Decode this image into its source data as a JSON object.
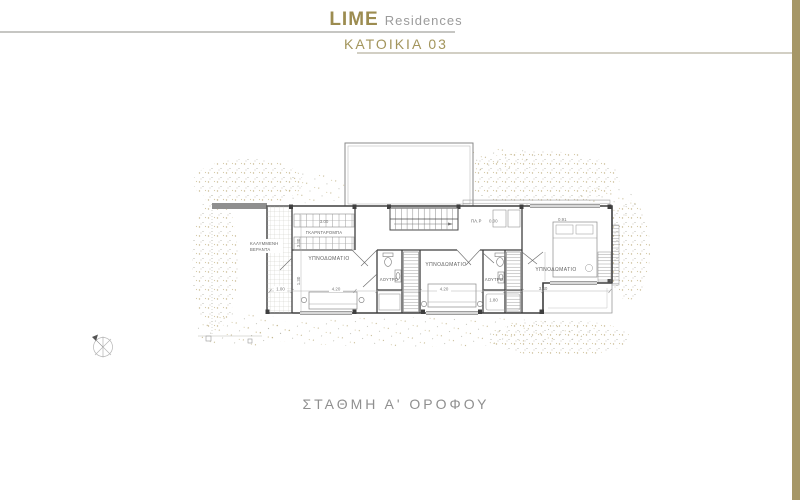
{
  "header": {
    "brand": "LIME",
    "brand_suffix": "Residences",
    "subtitle": "ΚΑΤΟΙΚΙΑ 03"
  },
  "footer": {
    "caption": "ΣΤΑΘΜΗ Α' ΟΡΟΦΟΥ"
  },
  "plan": {
    "rooms": {
      "veranda_line1": "ΚΑΛΥΜΜΕΝΗ",
      "veranda_line2": "ΒΕΡΑΝΤΑ",
      "wardrobe": "ΓΚΑΡΝΤΑΡΟΜΠΑ",
      "bedroom1": "ΥΠΝΟΔΩΜΑΤΙΟ",
      "bedroom2": "ΥΠΝΟΔΩΜΑΤΙΟ",
      "bedroom3": "ΥΠΝΟΔΩΜΑΤΙΟ",
      "bath1": "ΛΟΥΤΡΟ",
      "bath2": "ΛΟΥΤΡΟ",
      "landing": "ΠΛ.Ρ"
    },
    "dimensions": {
      "veranda_width": "1.00",
      "wardrobe_width": "3.00",
      "bedroom1_width": "4.20",
      "bedroom2_width": "4.20",
      "bath2_width": "1.80",
      "bedroom3_depth": "3.40",
      "bedroom3_top": "0.91",
      "level": "0.00",
      "left_upper": "3.30",
      "left_lower": "1.30"
    }
  },
  "colors": {
    "brand_gold": "#9c8c50",
    "subtitle_gold": "#a3955c",
    "accent_bar": "#a69767",
    "caption_gray": "#8f8f8f",
    "wall_dark": "#3f3f3f",
    "stipple_tan": "#b9a877"
  }
}
